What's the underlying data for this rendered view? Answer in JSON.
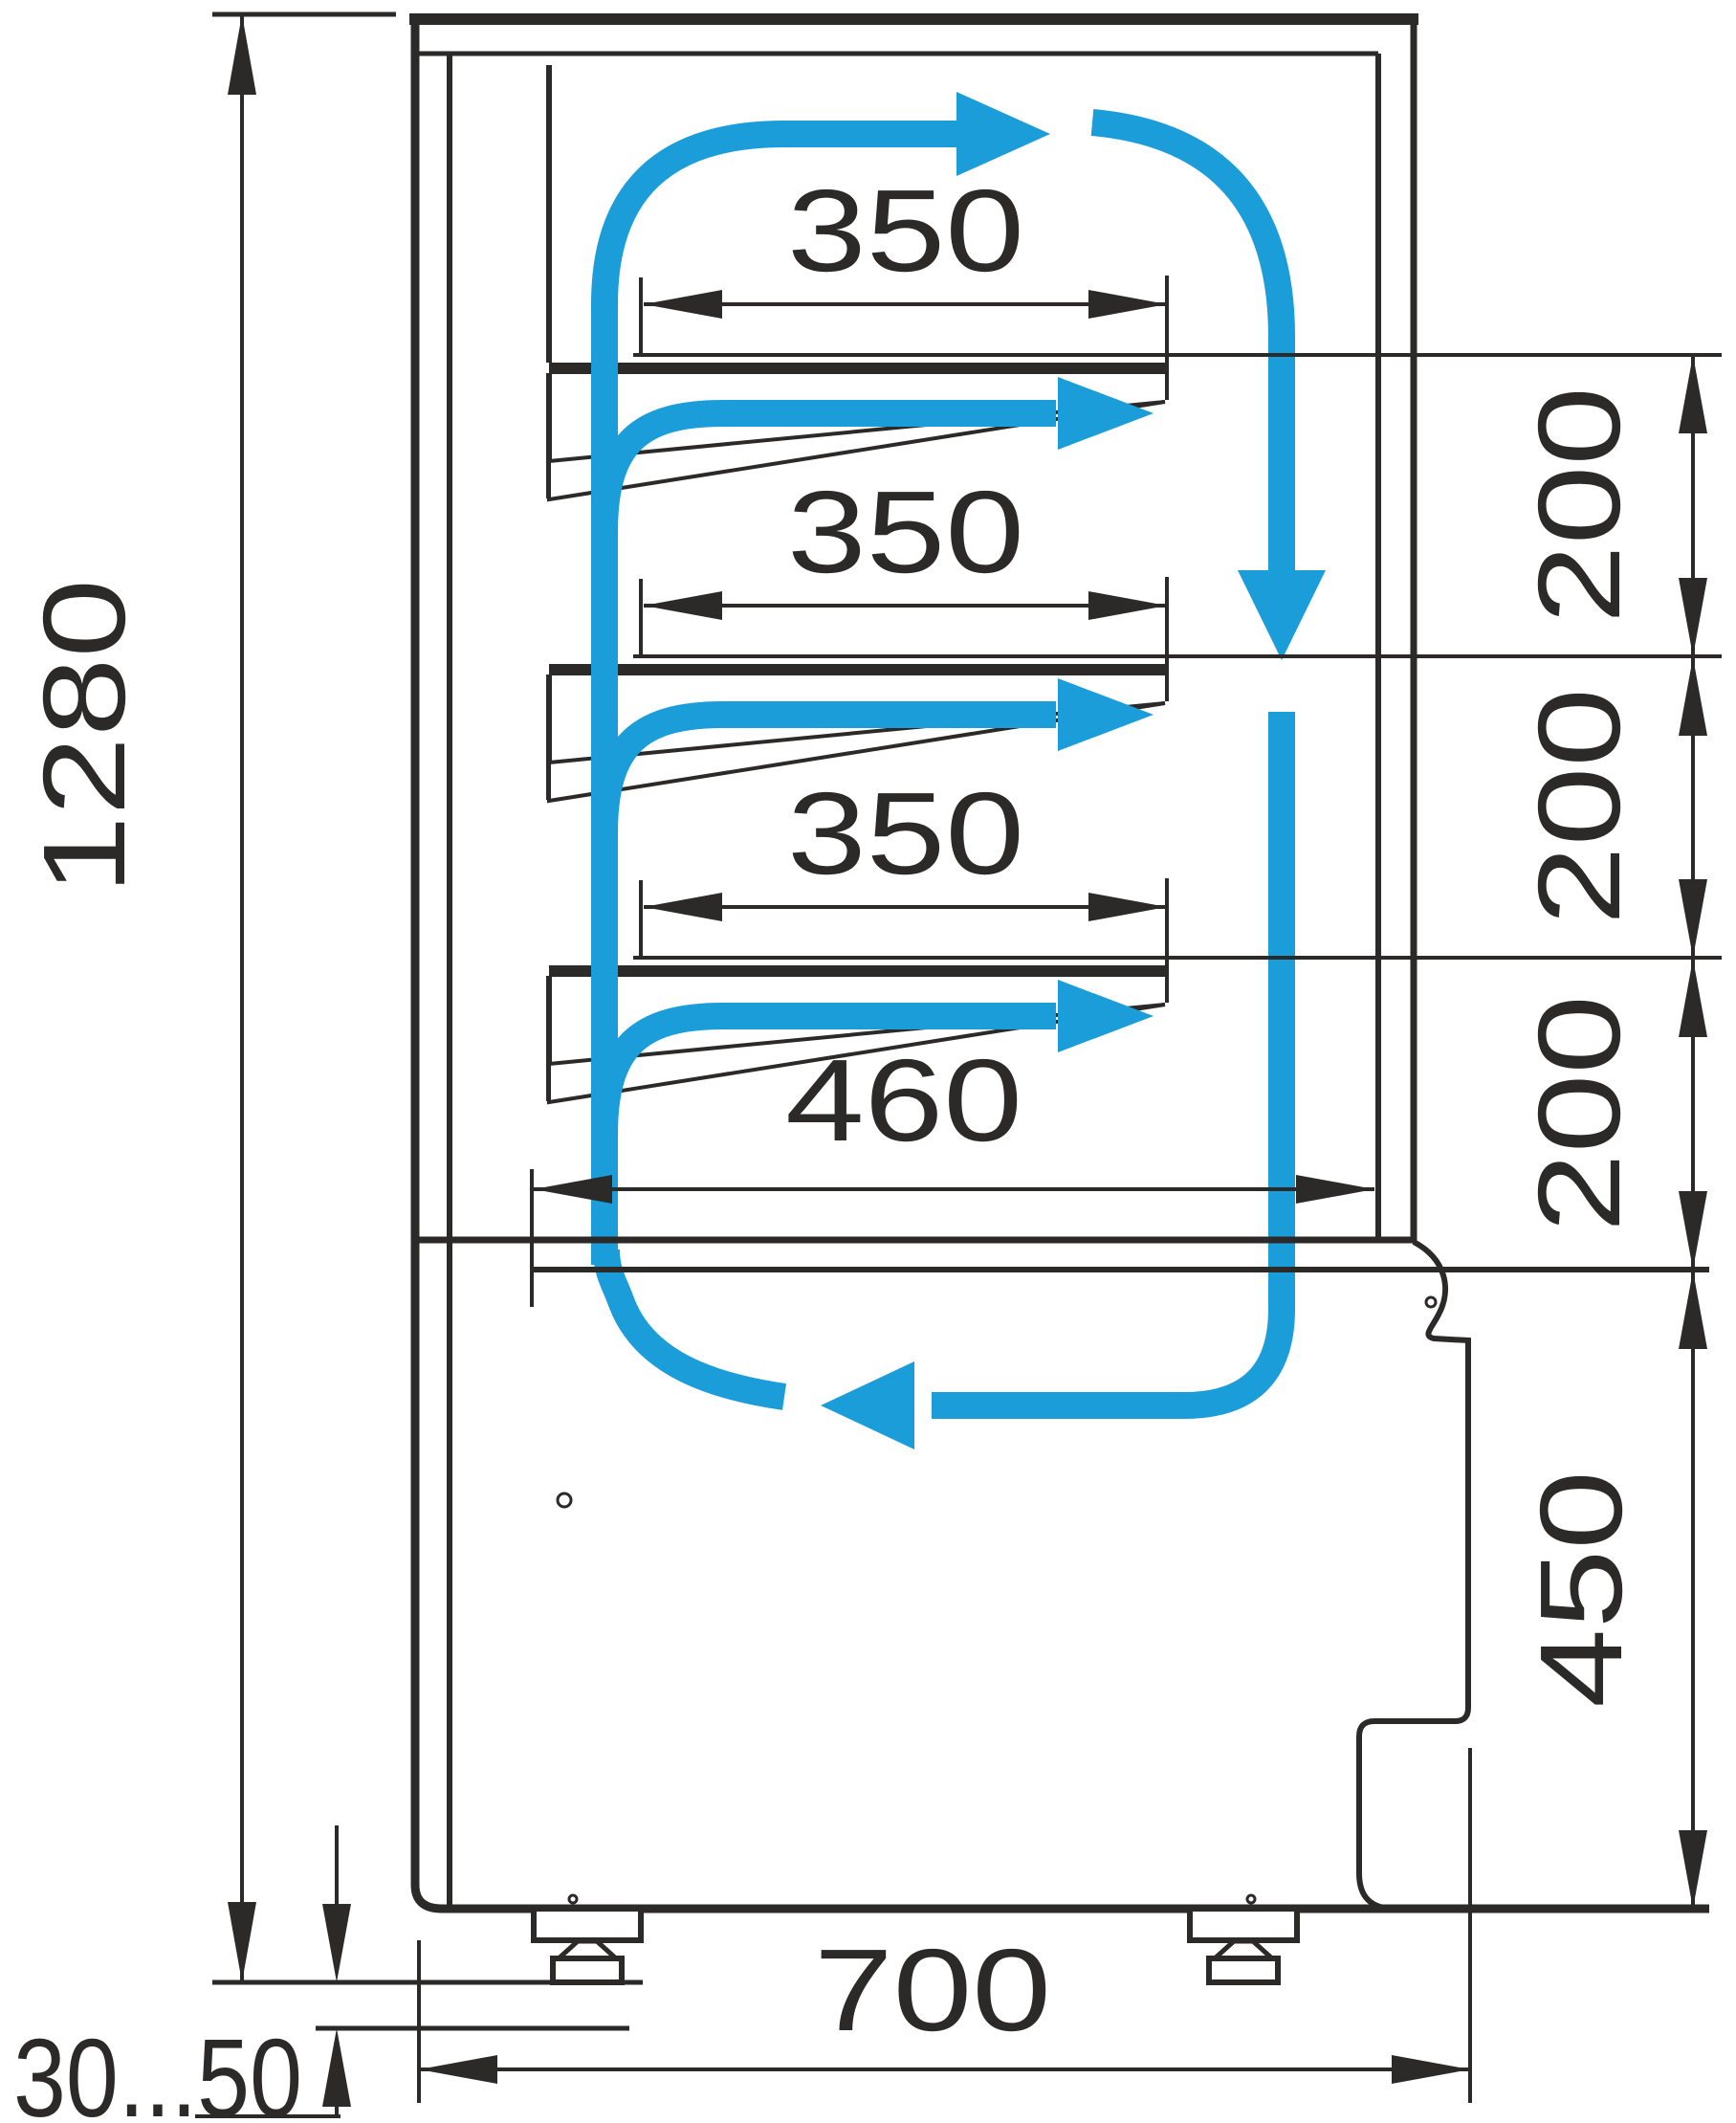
{
  "diagram": {
    "type": "refrigerated-display-case-side-section",
    "colors": {
      "line": "#2B2A29",
      "flow": "#1A9DD9",
      "background": "#FFFFFF"
    },
    "labels": {
      "overall_height": "1280",
      "shelf_depth_1": "350",
      "shelf_depth_2": "350",
      "shelf_depth_3": "350",
      "shelf_gap_1": "200",
      "shelf_gap_2": "200",
      "shelf_gap_3": "200",
      "well_depth": "460",
      "base_height": "450",
      "base_width": "700",
      "foot_adjustment": "30...50"
    }
  }
}
